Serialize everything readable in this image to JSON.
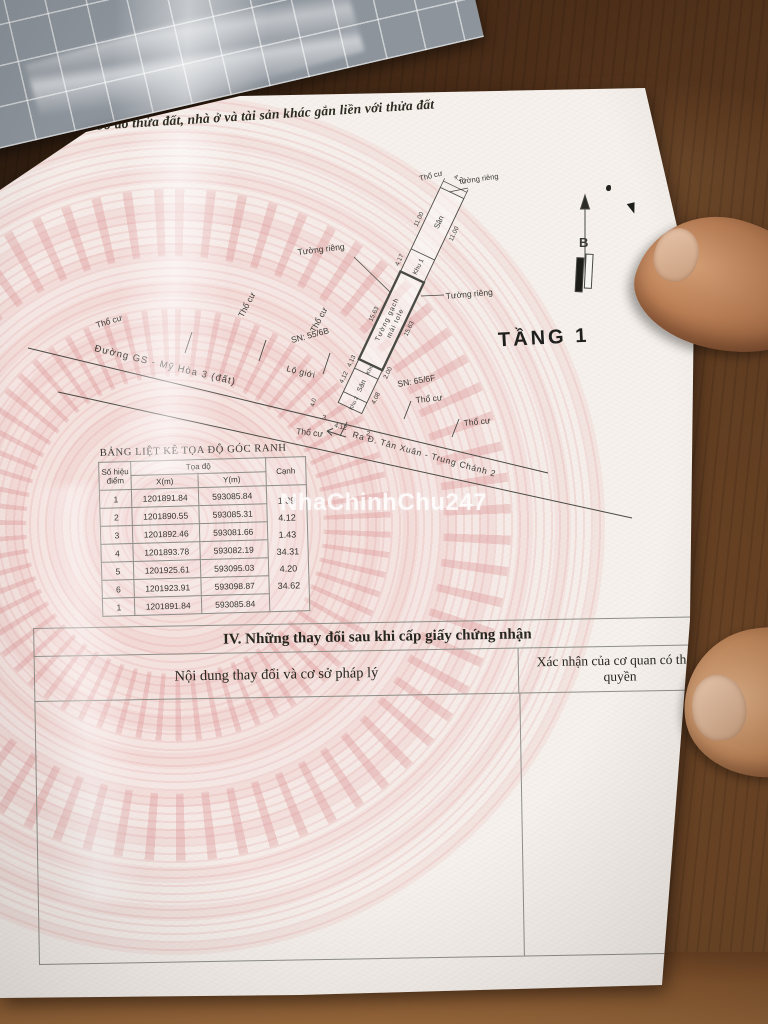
{
  "photo": {
    "watermark": "NhaChinhChu247"
  },
  "section3": {
    "title": "III. Sơ đồ thửa đất, nhà ở và tài sản khác gắn liền với thửa đất"
  },
  "diagram": {
    "floor_label": "TẦNG 1",
    "north_label": "B",
    "road_name": "Đường GS - Mỹ Hòa 3 (đất)",
    "road_direction": "Ra Đ. Tân Xuân - Trung Chánh 2",
    "boundary_label": "Lộ giới",
    "sn_left": "SN: 55/6B",
    "sn_right": "SN: 65/6F",
    "top_label_a": "Thổ cư",
    "top_label_b": "tường riêng",
    "wall_label_left": "Tường riêng",
    "wall_label_right": "Tường riêng",
    "wall_material_1": "Tường gạch",
    "wall_material_2": "mái tole",
    "zone_san_top": "Sân",
    "zone_khu1": "Khu 1",
    "zone_kho": "Kho",
    "zone_san_mid": "Sân",
    "zone_khu2": "Khu 2",
    "tho_cu_labels": [
      "Thổ cư",
      "Thổ cư",
      "Thổ cư",
      "Thổ cư",
      "Thổ cư",
      "Thổ cư"
    ],
    "dims": {
      "top_width": "4.20",
      "san_top_len": "11.00",
      "san_top_len_b": "11.00",
      "khu1_len": "4.17",
      "house_len": "15.63",
      "house_len_b": "15.63",
      "kho_len": "4.13",
      "san_mid_len": "4.12",
      "side_a": "2.00",
      "side_b": "4.08",
      "road_a": "3",
      "road_b": "4.12",
      "road_c": "2",
      "road_d": "4.0"
    }
  },
  "coord_table": {
    "title": "BẢNG LIỆT KÊ TỌA ĐỘ GÓC RANH",
    "header": {
      "point_1": "Số hiệu",
      "point_2": "điểm",
      "coord": "Tọa độ",
      "x": "X(m)",
      "y": "Y(m)",
      "edge": "Cạnh"
    },
    "rows": [
      {
        "pt": "1",
        "x": "1201891.84",
        "y": "593085.84"
      },
      {
        "pt": "2",
        "x": "1201890.55",
        "y": "593085.31"
      },
      {
        "pt": "3",
        "x": "1201892.46",
        "y": "593081.66"
      },
      {
        "pt": "4",
        "x": "1201893.78",
        "y": "593082.19"
      },
      {
        "pt": "5",
        "x": "1201925.61",
        "y": "593095.03"
      },
      {
        "pt": "6",
        "x": "1201923.91",
        "y": "593098.87"
      },
      {
        "pt": "1",
        "x": "1201891.84",
        "y": "593085.84"
      }
    ],
    "edges": [
      "1.39",
      "4.12",
      "1.43",
      "34.31",
      "4.20",
      "34.62"
    ]
  },
  "section4": {
    "title": "IV. Những thay đổi sau khi cấp giấy chứng nhận",
    "col_content": "Nội dung thay đổi và cơ sở pháp lý",
    "col_confirm": "Xác nhận của cơ quan có thẩm quyền"
  }
}
